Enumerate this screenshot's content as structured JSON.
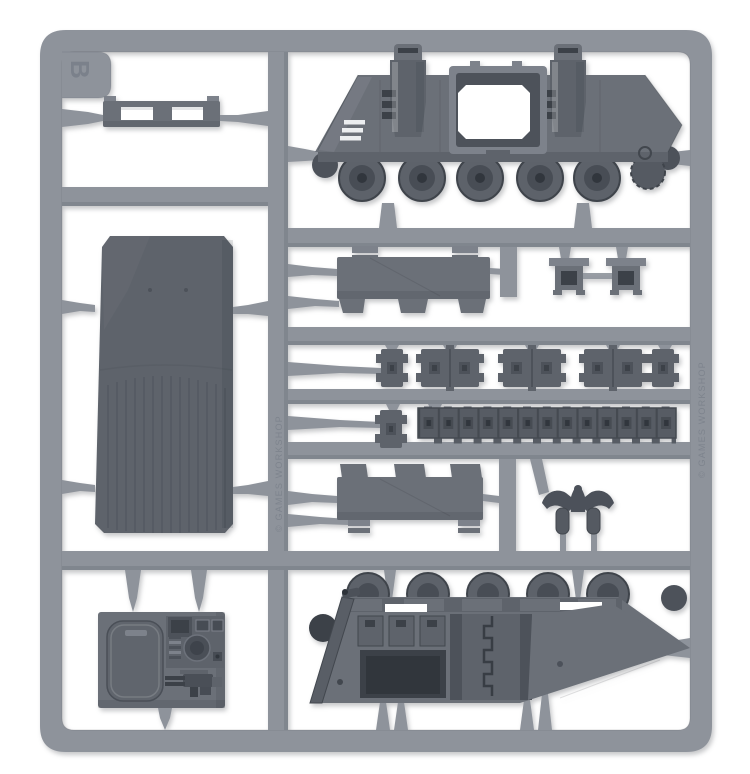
{
  "photo": {
    "subject": "Photograph of a grey plastic model-kit sprue (tank vehicle frame) on a white background",
    "sprue_letter": "B",
    "molded_text": "© GAMES WORKSHOP",
    "background": "white seamless"
  },
  "colors": {
    "c-bg": "#ffffff",
    "c-runner": "#8e939b",
    "c-runner-dk": "#7b8189",
    "c-part": "#6b7078",
    "c-part-md": "#5e636b",
    "c-part-dk": "#4d525a",
    "c-part-xd": "#3c4148",
    "c-part-lt": "#7d828b",
    "c-hole": "#ffffff",
    "c-slit": "#eceef0",
    "c-emboss": "#7a808a"
  },
  "parts": [
    {
      "id": "frame",
      "label": "Rectangular sprue frame with runners"
    },
    {
      "id": "vent-bar",
      "label": "Slotted vent bar"
    },
    {
      "id": "hull-side-exterior",
      "label": "Tank hull side, exterior, with road wheels, twin exhaust stacks and door opening"
    },
    {
      "id": "large-roof-panel",
      "label": "Large flat hull roof panel"
    },
    {
      "id": "track-guard-front",
      "label": "Track guard with mounting tabs"
    },
    {
      "id": "socket-brackets",
      "label": "Two small square socket brackets"
    },
    {
      "id": "track-link-segments",
      "label": "Row of short track-link segments"
    },
    {
      "id": "track-run",
      "label": "Long moulded track run"
    },
    {
      "id": "track-guard-rear",
      "label": "Second track guard, inverted"
    },
    {
      "id": "aquila",
      "label": "Imperial eagle ornament with two pendant legs"
    },
    {
      "id": "hull-side-interior",
      "label": "Tank hull side, interior, with seats, firing port and boarding ramp"
    },
    {
      "id": "hatch-console-plate",
      "label": "Plate with hatch door, control console and storm bolter"
    }
  ]
}
